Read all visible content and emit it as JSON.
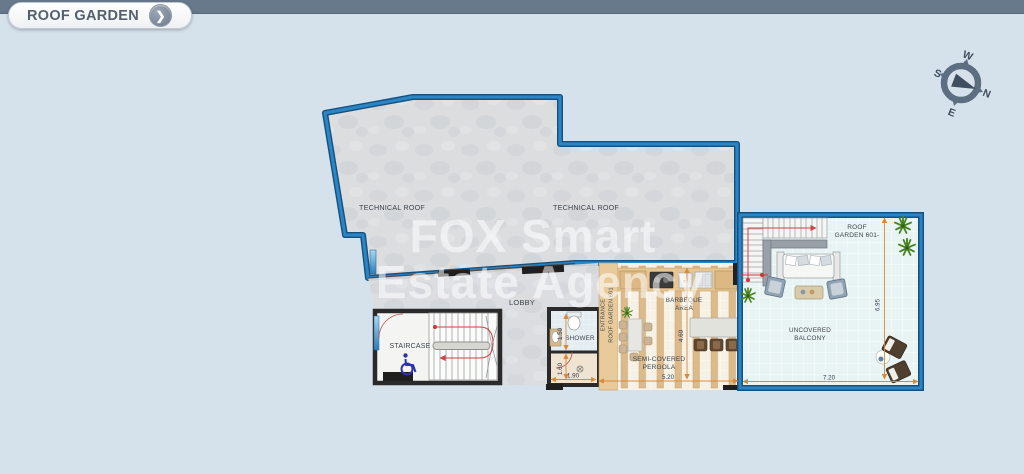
{
  "header": {
    "title": "ROOF GARDEN"
  },
  "icons": {
    "chevron_right": "❯"
  },
  "compass": {
    "n": "N",
    "e": "E",
    "s": "S",
    "w": "W"
  },
  "watermark": {
    "line1": "FOX Smart",
    "line2": "Estate Agency"
  },
  "labels": {
    "technical_roof": "TECHNICAL ROOF",
    "lobby": "LOBBY",
    "staircase": "STAIRCASE",
    "shower": "SHOWER",
    "entrance_line1": "ENTRANCE",
    "entrance_line2": "ROOF GARDEN 601",
    "barbeque_line1": "BARBEQUE",
    "barbeque_line2": "AREA",
    "pergola_line1": "SEMI-COVERED",
    "pergola_line2": "PERGOLA",
    "roof_garden_line1": "ROOF",
    "roof_garden_line2": "GARDEN 601-",
    "balcony_line1": "UNCOVERED",
    "balcony_line2": "BALCONY",
    "fridge": "Fr"
  },
  "dimensions": {
    "shower_width": "1.50",
    "wc_width": "1.60",
    "shower_block_length": "1.90",
    "pergola_length": "5.20",
    "pergola_depth": "4.60",
    "balcony_length": "7.20",
    "balcony_depth": "6.95"
  },
  "colors": {
    "plan_outline": "#2176b4",
    "dimension_line": "#d9893a",
    "dimension_text": "#333a52",
    "wall": "#2a2a2a",
    "topbar": "#68798c",
    "background": "#d6e2eb",
    "accessibility_icon": "#2f34a8"
  }
}
